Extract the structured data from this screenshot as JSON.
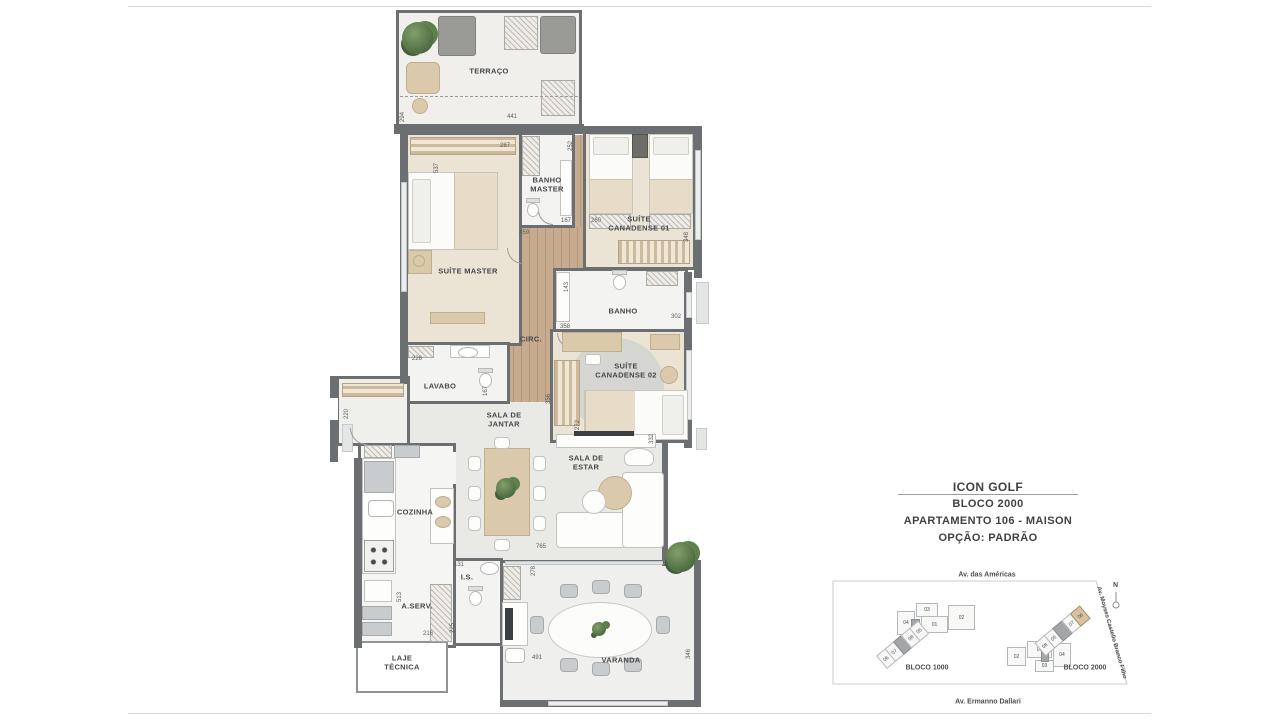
{
  "header": {
    "title": "ICON GOLF",
    "block": "BLOCO 2000",
    "apartment": "APARTAMENTO 106 - MAISON",
    "option": "OPÇÃO: PADRÃO"
  },
  "rooms": {
    "terraco": "TERRAÇO",
    "suite_master": "SUÍTE MASTER",
    "banho_master": "BANHO MASTER",
    "suite_canadense_01": "SUÍTE CANADENSE 01",
    "banho": "BANHO",
    "circ": "CIRC.",
    "lavabo": "LAVABO",
    "suite_canadense_02": "SUÍTE CANADENSE 02",
    "sala_jantar": "SALA DE JANTAR",
    "sala_estar": "SALA DE ESTAR",
    "cozinha": "COZINHA",
    "is": "I.S.",
    "aserv": "A.SERV.",
    "laje_tecnica": "LAJE TÉCNICA",
    "varanda": "VARANDA"
  },
  "dims": {
    "terraco_w": "441",
    "terraco_h": "294",
    "sm_w": "287",
    "sm_h": "537",
    "bm_h": "252",
    "bm_w": "167",
    "sc1_w": "260",
    "sc1_h": "348",
    "circ_w": "459",
    "banho_h": "143",
    "banho_w": "302",
    "sc2_w": "358",
    "sc2_h": "272",
    "lav_w": "226",
    "lav_h": "167",
    "hall_h": "220",
    "circ_h": "356",
    "sala_w": "765",
    "sala_h": "332",
    "is_w": "131",
    "coz_h": "513",
    "aserv_w": "216",
    "aserv_h": "225",
    "var_h1": "278",
    "var_w": "491",
    "var_h2": "346"
  },
  "map": {
    "street_top": "Av. das Américas",
    "street_bottom": "Av. Ermanno Dallari",
    "street_right": "Av. Moyses Castello Branco Filho",
    "north": "N",
    "bloco1000": {
      "label": "BLOCO 1000",
      "units": {
        "u01": "01",
        "u02": "02",
        "u03": "03",
        "u04": "04",
        "u05": "05",
        "u06": "06",
        "u07": "07",
        "u08": "08"
      }
    },
    "bloco2000": {
      "label": "BLOCO 2000",
      "highlighted_unit": "06",
      "units": {
        "u01": "01",
        "u02": "02",
        "u03": "03",
        "u04": "04",
        "u05": "05",
        "u06": "06",
        "u07": "07",
        "u08": "08"
      }
    }
  }
}
